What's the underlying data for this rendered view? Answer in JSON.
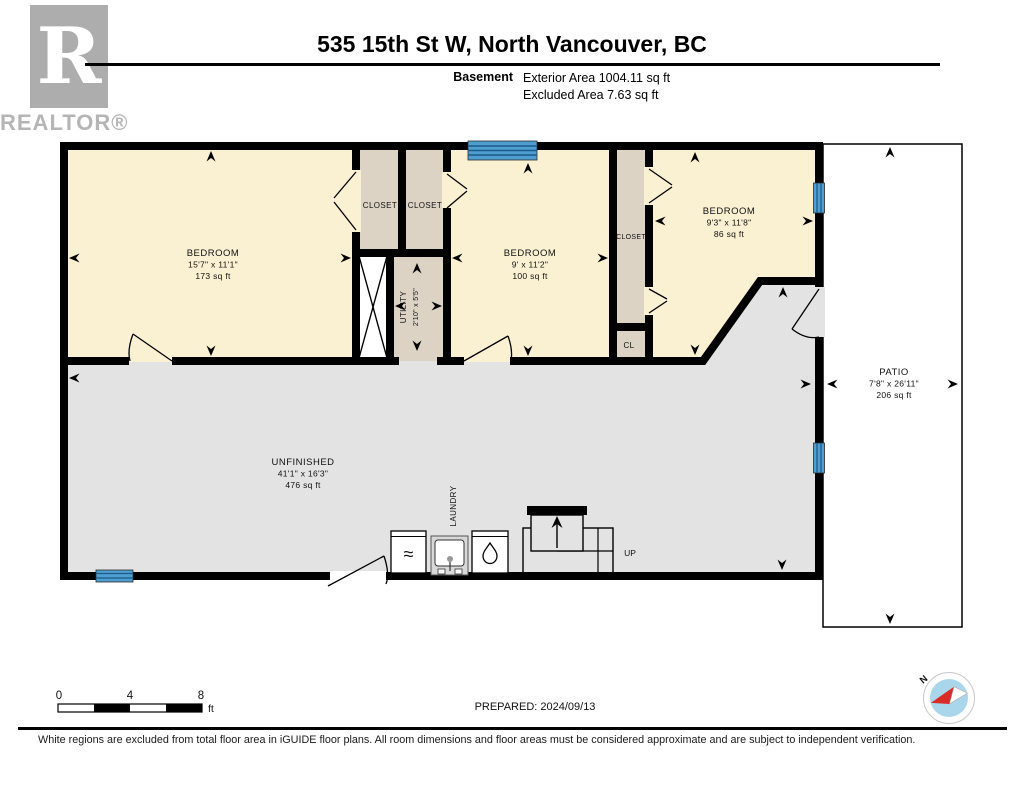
{
  "branding": {
    "logo_letter": "R",
    "logo_wordmark": "REALTOR®"
  },
  "header": {
    "title": "535 15th St W, North Vancouver, BC",
    "floor_label": "Basement",
    "exterior_area": "Exterior Area 1004.11 sq ft",
    "excluded_area": "Excluded Area 7.63 sq ft"
  },
  "rooms": {
    "bedroom_left": {
      "name": "BEDROOM",
      "dims": "15'7\" x 11'1\"",
      "area": "173 sq ft"
    },
    "closet_1": {
      "name": "CLOSET"
    },
    "closet_2": {
      "name": "CLOSET"
    },
    "utility": {
      "name": "UTILITY",
      "dims": "2'10\" x 5'5\""
    },
    "bedroom_middle": {
      "name": "BEDROOM",
      "dims": "9' x 11'2\"",
      "area": "100 sq ft"
    },
    "closet_3": {
      "name": "CLOSET"
    },
    "closet_4": {
      "name": "CL"
    },
    "bedroom_right": {
      "name": "BEDROOM",
      "dims": "9'3\" x 11'8\"",
      "area": "86 sq ft"
    },
    "unfinished": {
      "name": "UNFINISHED",
      "dims": "41'1\" x 16'3\"",
      "area": "476 sq ft"
    },
    "laundry": {
      "name": "LAUNDRY"
    },
    "patio": {
      "name": "PATIO",
      "dims": "7'8\" x 26'11\"",
      "area": "206 sq ft"
    },
    "stairs": {
      "label": "UP"
    }
  },
  "icons": {
    "washer": "≈"
  },
  "scale_bar": {
    "tick_0": "0",
    "tick_4": "4",
    "tick_8": "8",
    "unit": "ft"
  },
  "prepared": "PREPARED: 2024/09/13",
  "compass": {
    "north_label": "N"
  },
  "footer": {
    "disclaimer": "White regions are excluded from total floor area in iGUIDE floor plans. All room dimensions and floor areas must be considered approximate and are subject to independent verification."
  },
  "colors": {
    "wall": "#000000",
    "room_fill": "#FAF0D2",
    "closet_fill": "#DCD3C5",
    "unfinished_fill": "#E3E3E3",
    "window": "#4E9FD0",
    "compass_fill": "#A9D6EA",
    "compass_needle": "#D92B27"
  }
}
